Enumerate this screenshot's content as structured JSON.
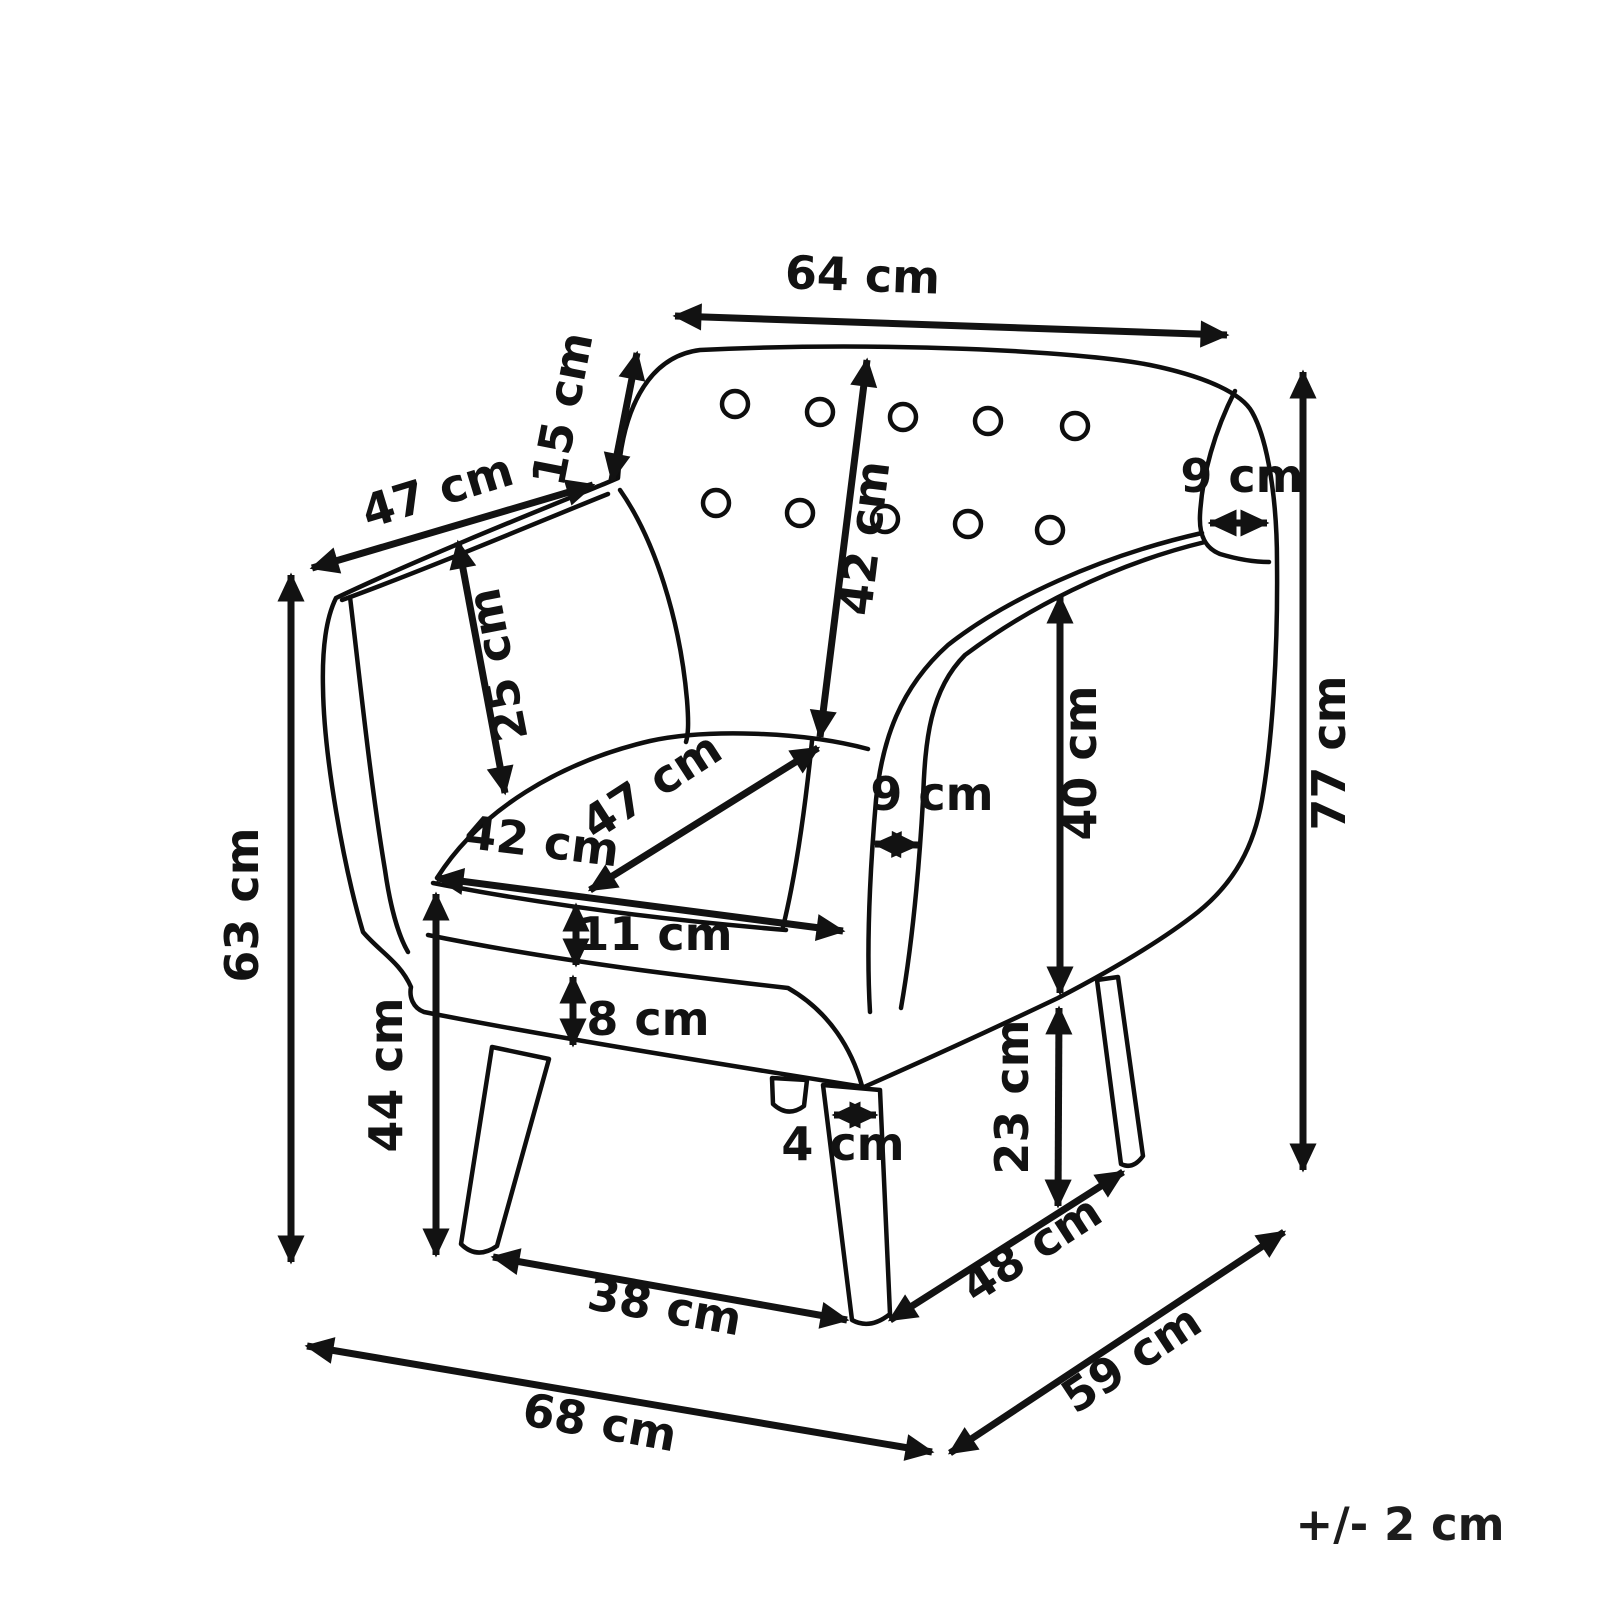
{
  "diagram": {
    "type": "furniture-dimension-diagram",
    "subject": "armchair",
    "unit": "cm",
    "tolerance_note": "+/- 2 cm",
    "labels": {
      "top_width": "64 cm",
      "back_top_depth": "15 cm",
      "armrest_length": "47 cm",
      "backrest_height": "42 cm",
      "wing_thickness": "9 cm",
      "total_height": "77 cm",
      "arm_inner_height": "25 cm",
      "arm_height_left": "63 cm",
      "seat_height": "44 cm",
      "seat_depth": "47 cm",
      "seat_width": "42 cm",
      "cushion_thickness": "11 cm",
      "base_height": "8 cm",
      "arm_band_width": "9 cm",
      "arm_height_right": "40 cm",
      "leg_height": "23 cm",
      "leg_width": "4 cm",
      "front_leg_span": "38 cm",
      "side_leg_span": "48 cm",
      "total_width": "68 cm",
      "total_depth": "59 cm"
    },
    "measurements_cm": {
      "top_width": 64,
      "back_top_depth": 15,
      "armrest_length": 47,
      "backrest_height": 42,
      "wing_thickness": 9,
      "total_height": 77,
      "arm_inner_height": 25,
      "arm_height_left": 63,
      "seat_height": 44,
      "seat_depth": 47,
      "seat_width": 42,
      "cushion_thickness": 11,
      "base_height": 8,
      "arm_band_width": 9,
      "arm_height_right": 40,
      "leg_height": 23,
      "leg_width": 4,
      "front_leg_span": 38,
      "side_leg_span": 48,
      "total_width": 68,
      "total_depth": 59,
      "tolerance": 2
    }
  }
}
